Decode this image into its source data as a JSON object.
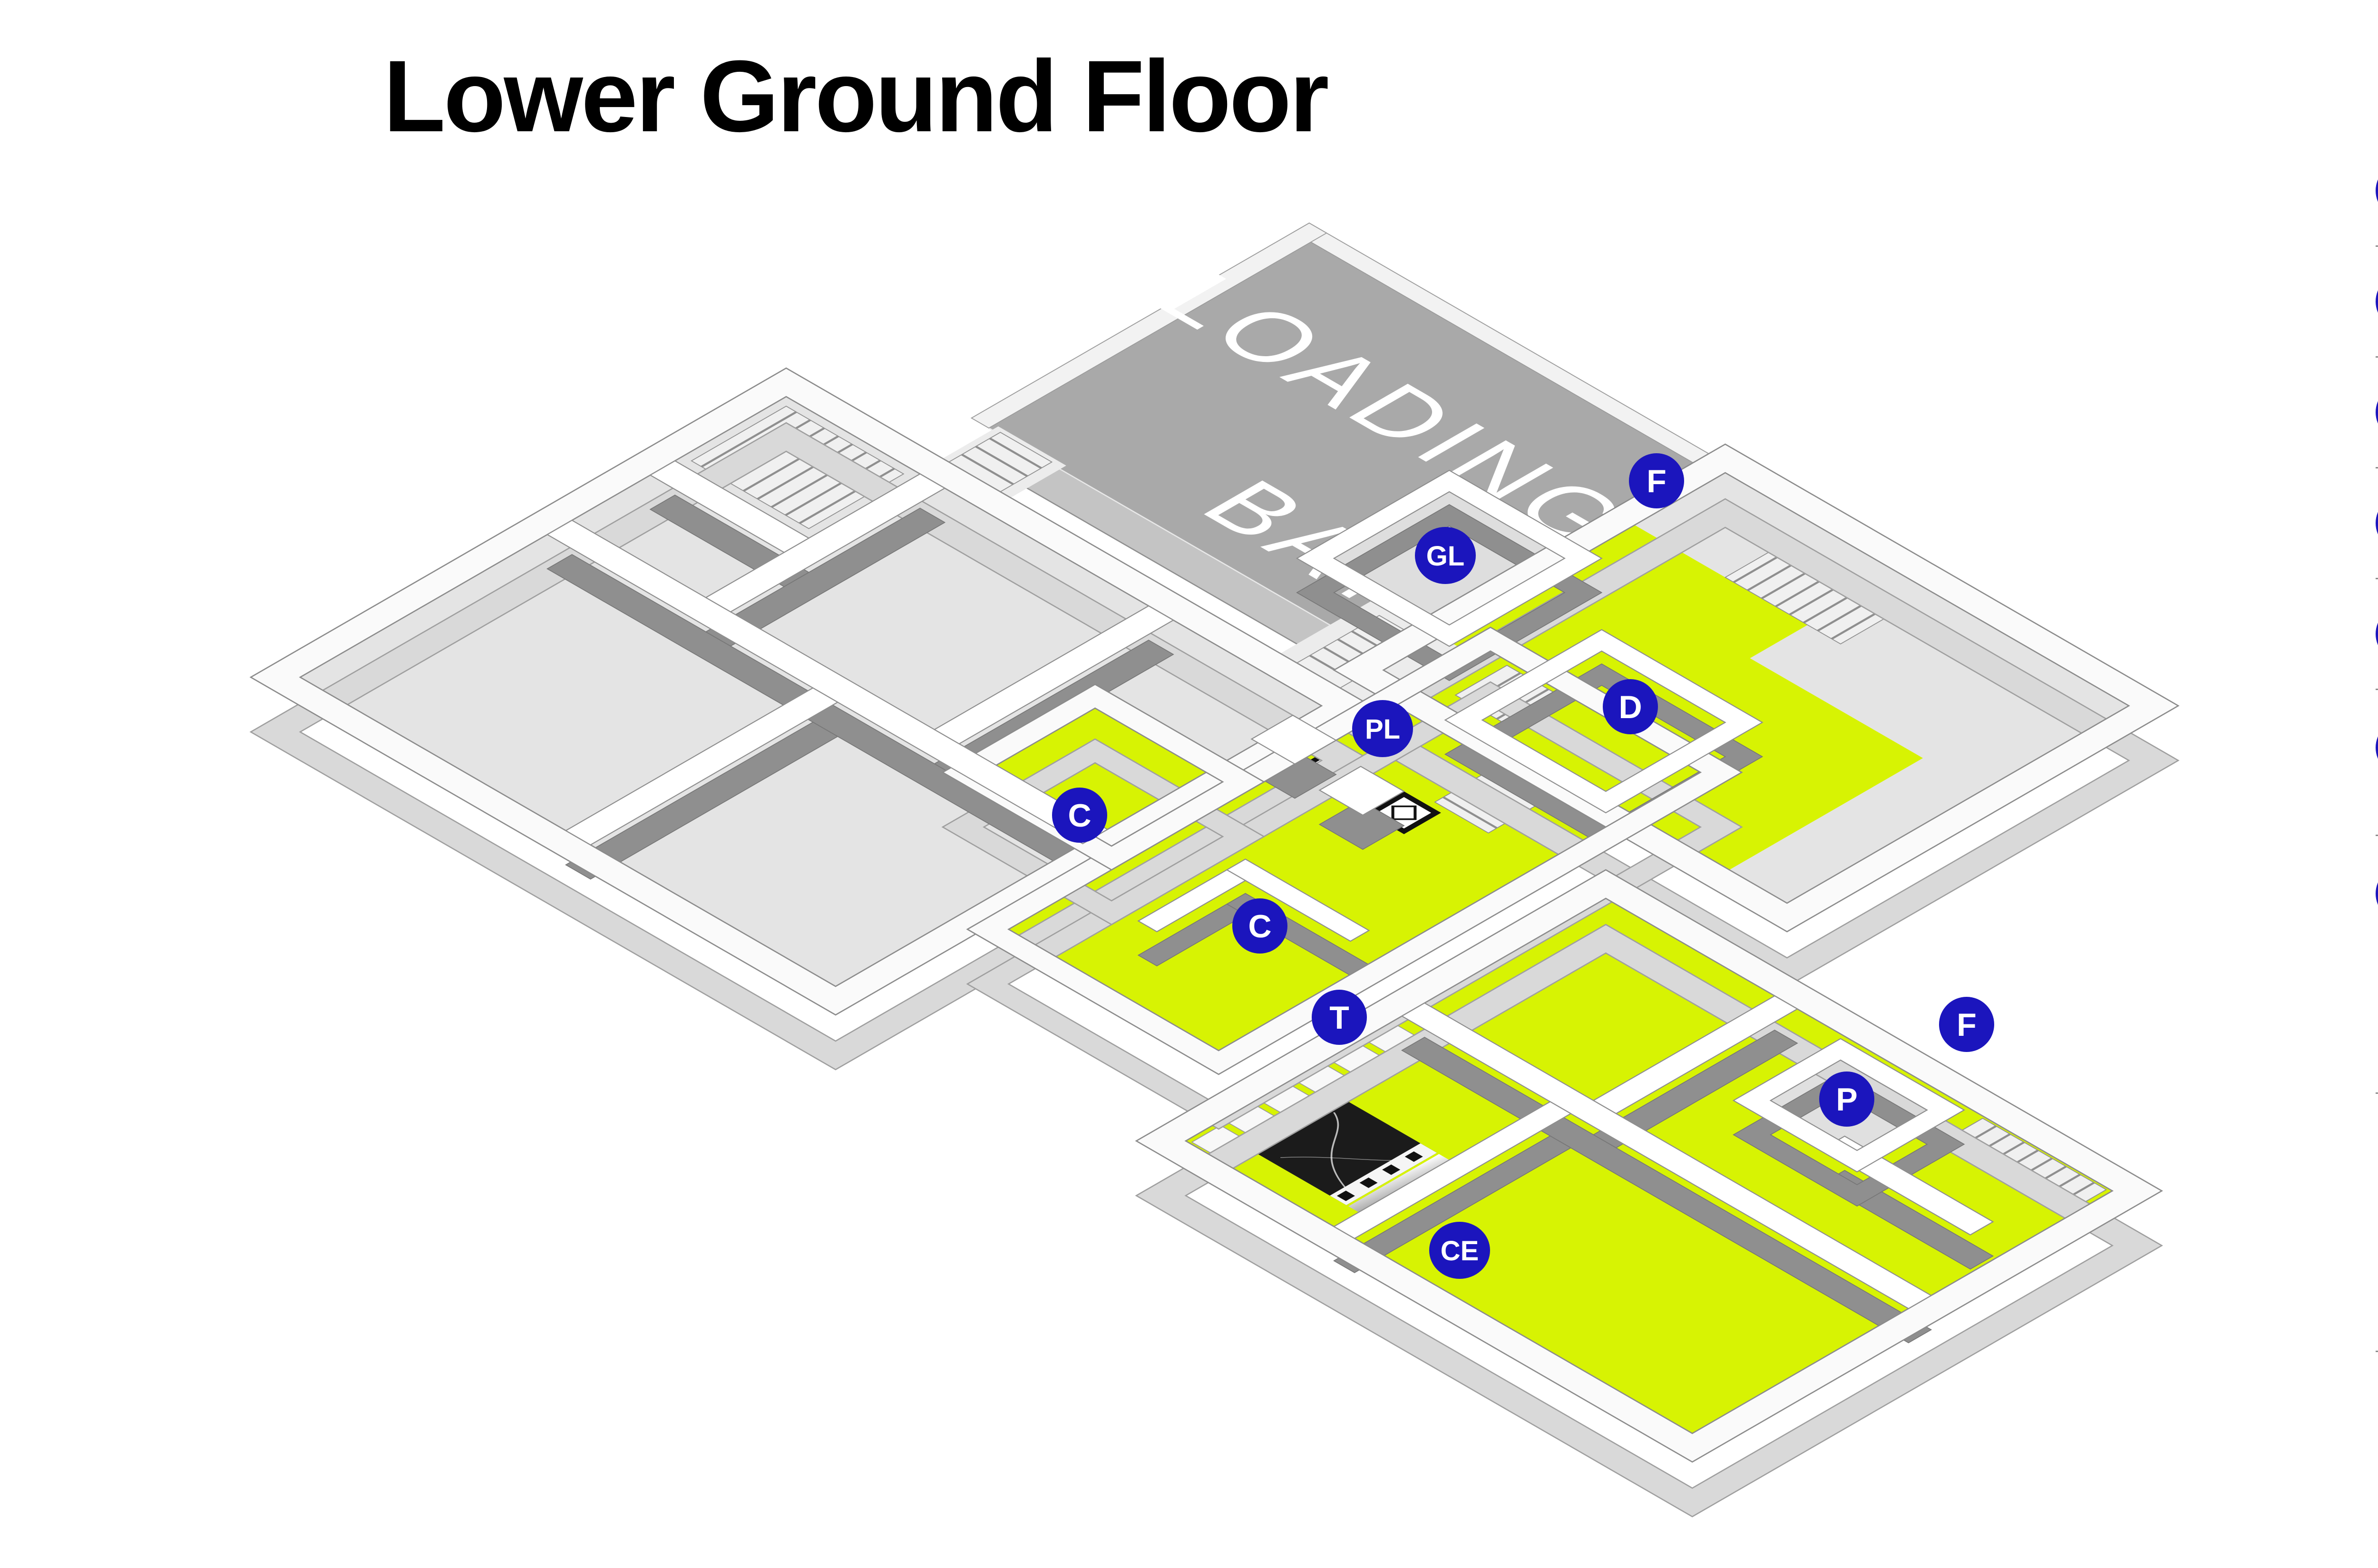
{
  "title": "Lower Ground Floor",
  "colors": {
    "badge": "#1b15bd",
    "highlight": "#d7f303",
    "platform": "#a9a9a9"
  },
  "plan": {
    "loading_bay": {
      "line1": "LOADING",
      "line2": "BAY"
    },
    "badges": [
      {
        "letter": "GL"
      },
      {
        "letter": "F"
      },
      {
        "letter": "D"
      },
      {
        "letter": "PL"
      },
      {
        "letter": "C"
      },
      {
        "letter": "C"
      },
      {
        "letter": "T"
      },
      {
        "letter": "P"
      },
      {
        "letter": "F"
      },
      {
        "letter": "CE"
      }
    ]
  },
  "legend": {
    "items": [
      {
        "icon": "T",
        "label": "Toliets",
        "note": ""
      },
      {
        "icon": "D",
        "label": "Disabled toilet",
        "note": ""
      },
      {
        "icon": "F",
        "label": "Fire exit",
        "note": ""
      },
      {
        "icon": "P",
        "label": "Power Socket",
        "note": ""
      },
      {
        "icon": "C",
        "label": "Cloakroom",
        "note": ""
      },
      {
        "icon": "PL",
        "label": "Passenger lift",
        "note": "Lifts are 96cm (W) x 130cm (D). Doors opening width 77cm."
      },
      {
        "icon": "GL",
        "label": "Goods lift",
        "note": "The maximum loading of the goods lift is 4200kg. The height of the door frame is 300cm (3m 7mm) (i.e. lowest point). The internal lift ceiling height is 390cm. The door way measures 190cm. The length of the lift when closed (at its minimum length) is 440cm and 500cm diagonal from corner to corner."
      },
      {
        "icon": "",
        "label": "Loading bay",
        "note": "The parking bay is located at the rear of the Gallery, which you can access turning right onto Turk's Row from Lower Sloane Street and then taking the first right onto Cavalry Square. Access time: Monday-Friday 9am-10pm, Saturday 8.30am-4pm, Sunday 11am-4pm."
      }
    ]
  }
}
